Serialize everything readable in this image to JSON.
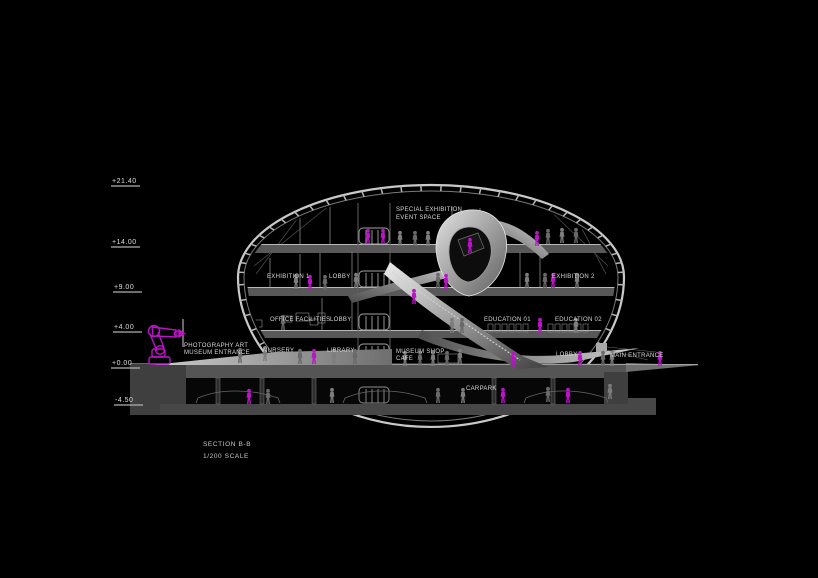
{
  "drawing": {
    "section_title": "SECTION B-B",
    "scale_label": "1/200 SCALE"
  },
  "elevation_markers": [
    {
      "label": "+21.40",
      "x": 112,
      "y": 183,
      "line_y": 186
    },
    {
      "label": "+14.00",
      "x": 112,
      "y": 244,
      "line_y": 247
    },
    {
      "label": "+9.00",
      "x": 114,
      "y": 289,
      "line_y": 292
    },
    {
      "label": "+4.00",
      "x": 114,
      "y": 329,
      "line_y": 332
    },
    {
      "label": "+0.00",
      "x": 112,
      "y": 365,
      "line_y": 368
    },
    {
      "label": "-4.50",
      "x": 115,
      "y": 402,
      "line_y": 405
    }
  ],
  "room_labels": [
    {
      "text": "SPECIAL EXHIBITION",
      "x": 396,
      "y": 211
    },
    {
      "text": "EVENT SPACE",
      "x": 396,
      "y": 219
    },
    {
      "text": "EXHIBITION 1",
      "x": 267,
      "y": 278
    },
    {
      "text": "LOBBY",
      "x": 329,
      "y": 278
    },
    {
      "text": "EXHIBITION 2",
      "x": 552,
      "y": 278
    },
    {
      "text": "OFFICE FACILITIES",
      "x": 270,
      "y": 321
    },
    {
      "text": "LOBBY",
      "x": 330,
      "y": 321
    },
    {
      "text": "EDUCATION 01",
      "x": 484,
      "y": 321
    },
    {
      "text": "EDUCATION 02",
      "x": 555,
      "y": 321
    },
    {
      "text": "NURSERY",
      "x": 263,
      "y": 352
    },
    {
      "text": "LIBRARY",
      "x": 327,
      "y": 352
    },
    {
      "text": "MUSEUM SHOP",
      "x": 396,
      "y": 353
    },
    {
      "text": "CAFE",
      "x": 396,
      "y": 360
    },
    {
      "text": "LOBBY",
      "x": 556,
      "y": 356
    },
    {
      "text": "MAIN ENTRANCE",
      "x": 610,
      "y": 357
    },
    {
      "text": "PHOTOGRAPHY ART",
      "x": 184,
      "y": 347
    },
    {
      "text": "MUSEUM ENTRANCE",
      "x": 184,
      "y": 354
    },
    {
      "text": "CARPARK",
      "x": 466,
      "y": 390
    }
  ],
  "figures": {
    "magenta": [
      [
        368,
        244
      ],
      [
        383,
        244
      ],
      [
        537,
        246
      ],
      [
        470,
        253
      ],
      [
        310,
        290
      ],
      [
        446,
        289
      ],
      [
        553,
        288
      ],
      [
        414,
        304
      ],
      [
        540,
        333
      ],
      [
        314,
        364
      ],
      [
        513,
        367
      ],
      [
        580,
        366
      ],
      [
        660,
        366
      ],
      [
        249,
        404
      ],
      [
        503,
        403
      ],
      [
        568,
        403
      ]
    ],
    "gray": [
      [
        400,
        246
      ],
      [
        415,
        246
      ],
      [
        428,
        246
      ],
      [
        548,
        244
      ],
      [
        562,
        243
      ],
      [
        576,
        243
      ],
      [
        296,
        289
      ],
      [
        325,
        290
      ],
      [
        356,
        288
      ],
      [
        438,
        288
      ],
      [
        527,
        288
      ],
      [
        545,
        288
      ],
      [
        577,
        288
      ],
      [
        283,
        330
      ],
      [
        452,
        333
      ],
      [
        462,
        333
      ],
      [
        576,
        333
      ],
      [
        240,
        363
      ],
      [
        265,
        361
      ],
      [
        300,
        364
      ],
      [
        334,
        364
      ],
      [
        355,
        364
      ],
      [
        405,
        366
      ],
      [
        420,
        366
      ],
      [
        433,
        366
      ],
      [
        447,
        366
      ],
      [
        460,
        364
      ],
      [
        603,
        366
      ],
      [
        612,
        366
      ],
      [
        268,
        404
      ],
      [
        332,
        403
      ],
      [
        438,
        403
      ],
      [
        463,
        403
      ],
      [
        548,
        402
      ],
      [
        610,
        399
      ]
    ]
  },
  "cars": [
    [
      196,
      403
    ],
    [
      343,
      403
    ],
    [
      524,
      403
    ]
  ],
  "colors": {
    "background": "#000000",
    "magenta": "#bb14c8",
    "shell": "#c9c9c9",
    "shell_inner": "#7a7a7a",
    "slab": "#585858",
    "slab_edge": "#b8b8b8",
    "detail_line": "#8a8a8a",
    "figure_gray": "#7d7d7d",
    "text": "#d6d6d6"
  }
}
